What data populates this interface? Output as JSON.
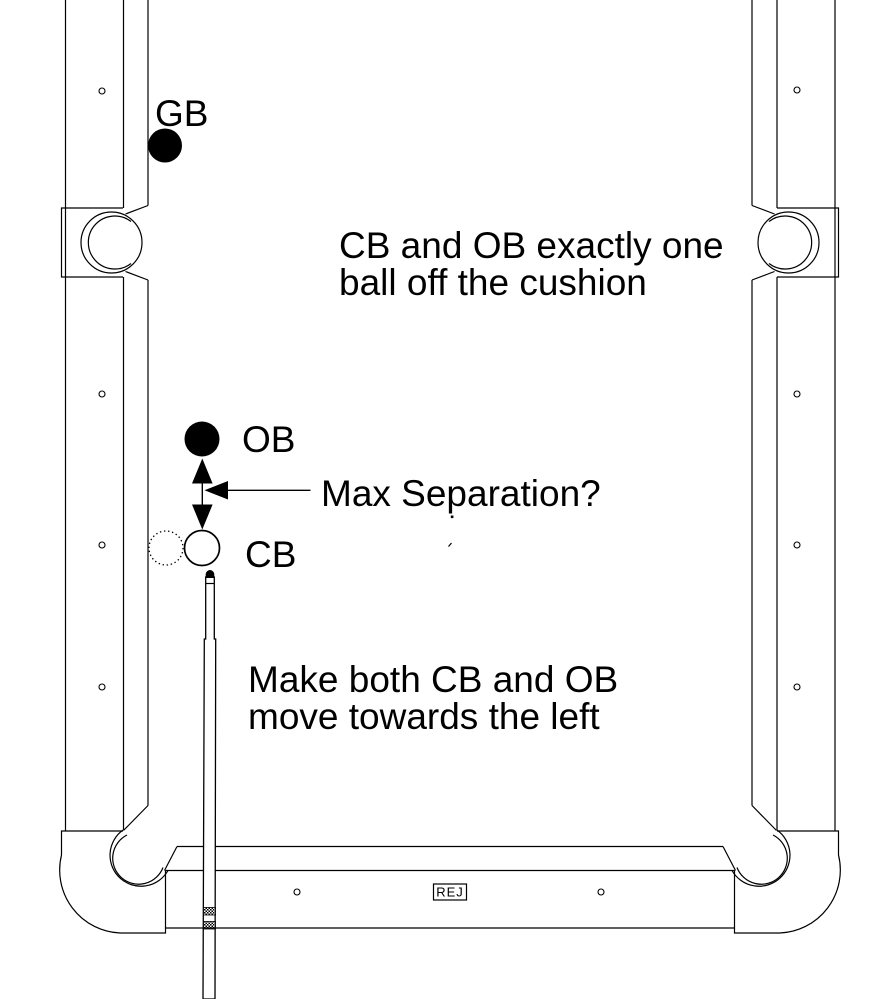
{
  "annotations": {
    "cushion_note_line1": "CB and OB exactly one",
    "cushion_note_line2": "ball off the cushion",
    "separation_label": "Max Separation?",
    "action_note_line1": "Make both CB and OB",
    "action_note_line2": "move towards the left"
  },
  "balls": {
    "gb_label": "GB",
    "ob_label": "OB",
    "cb_label": "CB"
  },
  "watermark_label": "REJ",
  "colors": {
    "line": "#000000",
    "background": "#ffffff",
    "object_ball_fill": "#000000",
    "cue_ball_fill": "#ffffff"
  }
}
